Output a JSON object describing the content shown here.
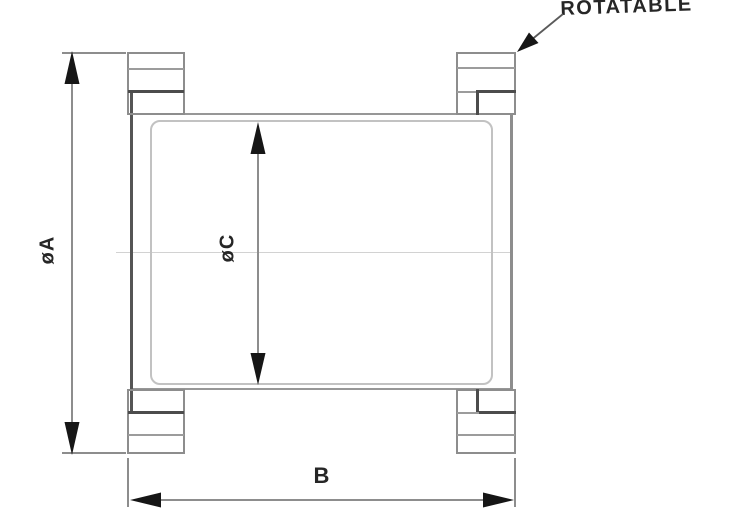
{
  "drawing": {
    "callout": "ROTATABLE",
    "dim_a": "øA",
    "dim_c": "øC",
    "dim_b": "B"
  },
  "colors": {
    "background": "#ffffff",
    "ink_dark": "#4c4c4c",
    "ink": "#8d8d8d",
    "ink_light": "#c2c2c2",
    "faint": "#d2d2d2",
    "arrow": "#161616",
    "label": "#262626"
  }
}
